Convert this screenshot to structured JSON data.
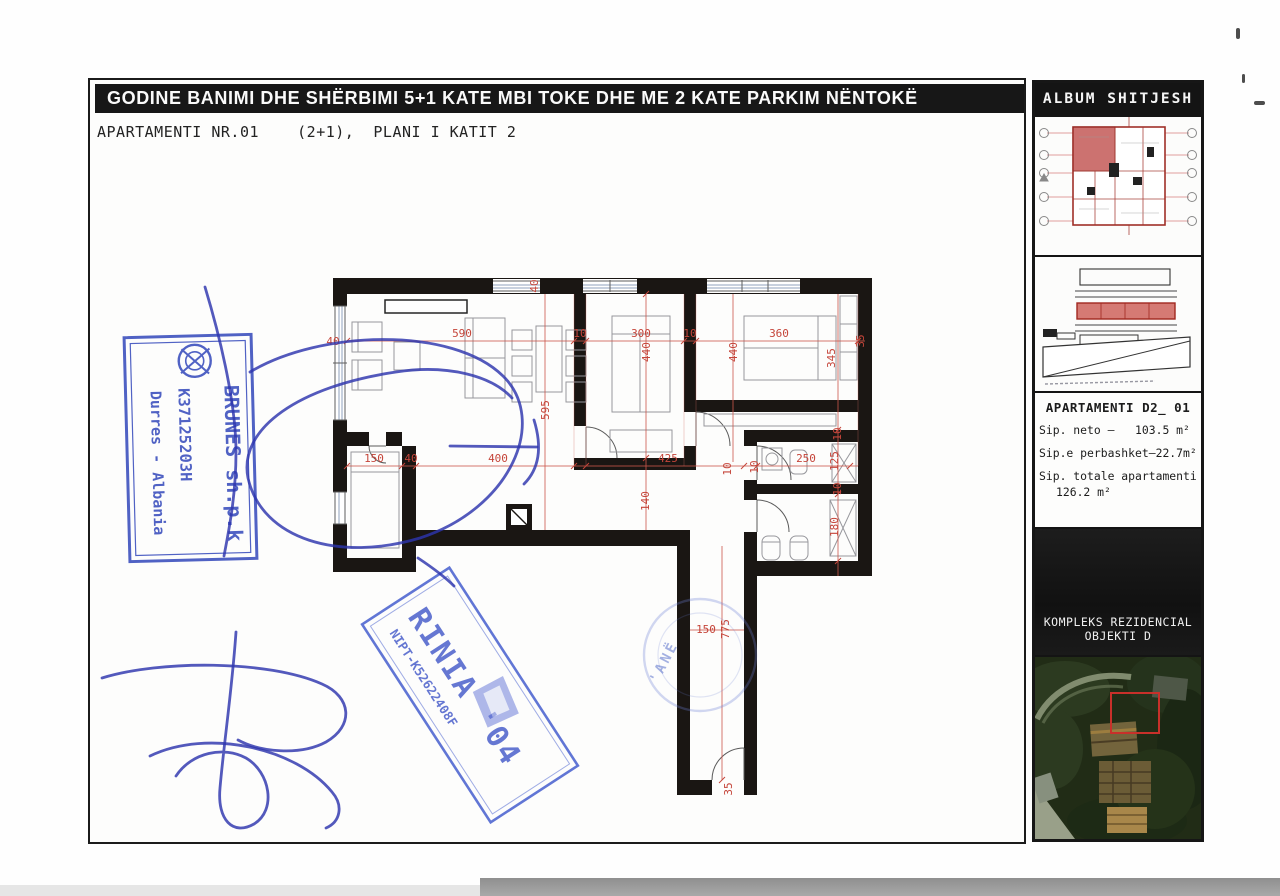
{
  "page": {
    "title": "GODINE BANIMI DHE SHËRBIMI  5+1 KATE MBI TOKE DHE ME 2 KATE PARKIM NËNTOKË",
    "subtitle": "APARTAMENTI NR.01    (2+1),  PLANI I KATIT 2"
  },
  "sidebar": {
    "header": "ALBUM  SHITJESH",
    "apartment_label": "APARTAMENTI  D2_  01",
    "area_net": "Sip. neto –   103.5 m²",
    "area_common": "Sip.e perbashket–22.7m²",
    "area_total_label": "Sip. totale apartamenti",
    "area_total_value": "126.2 m²",
    "complex_line1": "KOMPLEKS REZIDENCIAL",
    "complex_line2": "OBJEKTI D"
  },
  "plan": {
    "dims": {
      "left_wall": "40",
      "top_wall": "40",
      "living_width": "590",
      "wall_a": "10",
      "bedroom1_width": "300",
      "wall_b": "10",
      "bedroom2_width": "360",
      "right_edge": "35",
      "living_depth": "595",
      "bedroom1_depth": "440",
      "bedroom2_depth_line": "440",
      "bedroom2_depth": "345",
      "storage_width": "150",
      "storage_wall": "40",
      "hall_width": "400",
      "hall_east_width": "425",
      "wall_c": "10",
      "wall_d": "10",
      "bath1_width": "250",
      "bath1_depth": "125",
      "wall_e": "10",
      "wall_f": "10",
      "hall_depth": "140",
      "bath2_depth": "180",
      "corridor_width": "150",
      "corridor_length": "775",
      "corridor_end_wall": "35"
    }
  },
  "stamps": {
    "round_stamp_text": "'ANË",
    "brunes": {
      "name": "BRUNES sh.p.k",
      "reg_no": "K37125203H",
      "city": "Durres - Albania"
    },
    "rinia": {
      "name": "RINIA '04",
      "nipt": "NIPT-K52622408F"
    }
  }
}
